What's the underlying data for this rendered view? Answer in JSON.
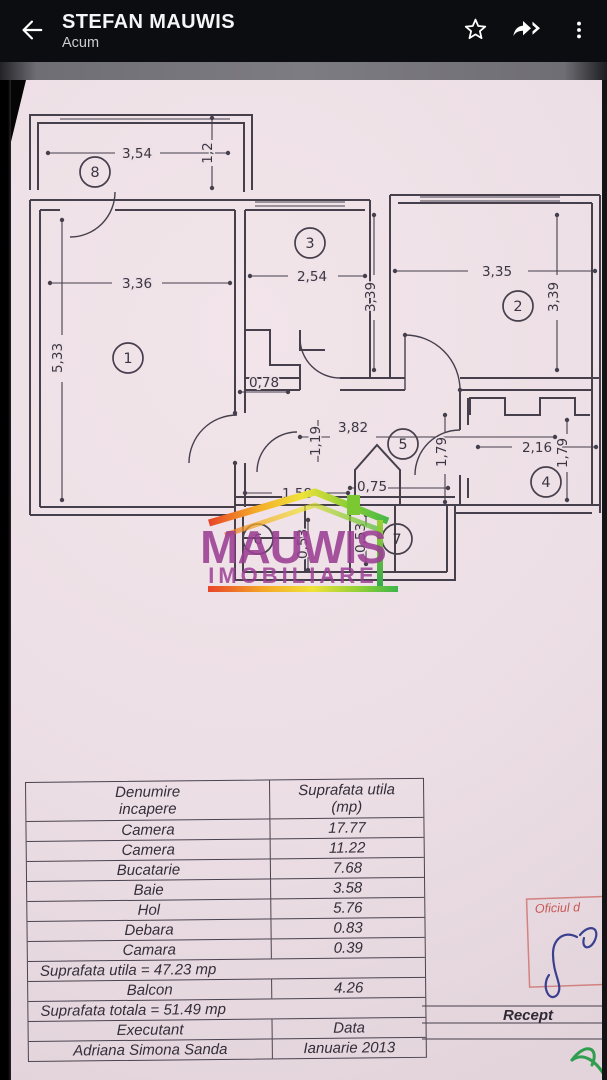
{
  "app_bar": {
    "title": "STEFAN MAUWIS",
    "subtitle": "Acum",
    "back_icon": "back-arrow",
    "actions": [
      {
        "name": "star",
        "glyph": "star-outline"
      },
      {
        "name": "forward",
        "glyph": "forward-double-arrow"
      },
      {
        "name": "menu",
        "glyph": "vertical-dots"
      }
    ]
  },
  "plan": {
    "dim_labels": [
      {
        "t": "3,54",
        "x": 137,
        "y": 78
      },
      {
        "t": "1,2",
        "x": 212,
        "y": 73,
        "r": 1
      },
      {
        "t": "3,36",
        "x": 137,
        "y": 208
      },
      {
        "t": "2,54",
        "x": 312,
        "y": 201
      },
      {
        "t": "3,35",
        "x": 497,
        "y": 196
      },
      {
        "t": "3,39",
        "x": 375,
        "y": 217,
        "r": 1
      },
      {
        "t": "3,39",
        "x": 558,
        "y": 217,
        "r": 1
      },
      {
        "t": "5,33",
        "x": 62,
        "y": 278,
        "r": 1
      },
      {
        "t": "0,78",
        "x": 264,
        "y": 307
      },
      {
        "t": "1,19",
        "x": 320,
        "y": 361,
        "r": 1
      },
      {
        "t": "3,82",
        "x": 353,
        "y": 352
      },
      {
        "t": "1,79",
        "x": 446,
        "y": 372,
        "r": 1
      },
      {
        "t": "2,16",
        "x": 537,
        "y": 372
      },
      {
        "t": "1,79",
        "x": 567,
        "y": 373,
        "r": 1
      },
      {
        "t": "1,58",
        "x": 297,
        "y": 418
      },
      {
        "t": "0,75",
        "x": 372,
        "y": 411
      },
      {
        "t": "0,53",
        "x": 307,
        "y": 464,
        "r": 1
      },
      {
        "t": "0,53",
        "x": 365,
        "y": 458,
        "r": 1
      }
    ],
    "room_numbers": [
      {
        "n": "8",
        "x": 95,
        "y": 92
      },
      {
        "n": "1",
        "x": 128,
        "y": 278
      },
      {
        "n": "3",
        "x": 310,
        "y": 163
      },
      {
        "n": "2",
        "x": 518,
        "y": 226
      },
      {
        "n": "5",
        "x": 403,
        "y": 364
      },
      {
        "n": "4",
        "x": 546,
        "y": 402
      },
      {
        "n": "6",
        "x": 258,
        "y": 459
      },
      {
        "n": "7",
        "x": 397,
        "y": 459
      }
    ]
  },
  "watermark": {
    "line1": "MAUWIS",
    "line2": "IMOBILIARE",
    "purple": "#9b3e93",
    "roof_colors": [
      "#e8452a",
      "#f4a927",
      "#f0e23a",
      "#8fcf35",
      "#3cb54a"
    ]
  },
  "table": {
    "header": {
      "col1_line1": "Denumire",
      "col1_line2": "incapere",
      "col2_line1": "Suprafata utila",
      "col2_line2": "(mp)"
    },
    "rows": [
      {
        "type": "pair",
        "name": "Camera",
        "value": "17.77"
      },
      {
        "type": "pair",
        "name": "Camera",
        "value": "11.22"
      },
      {
        "type": "pair",
        "name": "Bucatarie",
        "value": "7.68"
      },
      {
        "type": "pair",
        "name": "Baie",
        "value": "3.58"
      },
      {
        "type": "pair",
        "name": "Hol",
        "value": "5.76"
      },
      {
        "type": "pair",
        "name": "Debara",
        "value": "0.83"
      },
      {
        "type": "pair",
        "name": "Camara",
        "value": "0.39"
      },
      {
        "type": "full",
        "text": "Suprafata utila  = 47.23 mp"
      },
      {
        "type": "pair",
        "name": "Balcon",
        "value": "4.26"
      },
      {
        "type": "full",
        "text": "Suprafata totala  = 51.49 mp"
      },
      {
        "type": "pair",
        "name": "Executant",
        "value": "Data"
      },
      {
        "type": "pair",
        "name": "Adriana Simona Sanda",
        "value": "Ianuarie  2013"
      }
    ],
    "side_column_label": "Recept"
  },
  "stamp": {
    "title": "Oficiul d"
  },
  "colors": {
    "paper": "#ecdfe5",
    "ink": "#4a4350",
    "stamp_red": "#c04a42",
    "pen_green": "#2f9e4f",
    "signature_blue": "#3a3f8f",
    "logo_purple": "#9b3e93"
  }
}
